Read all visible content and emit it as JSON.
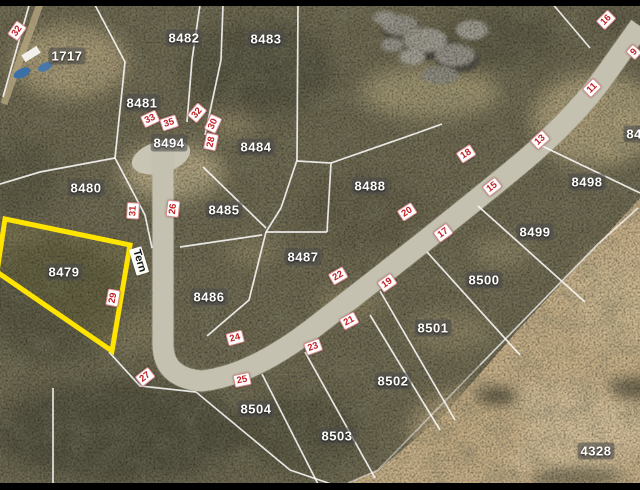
{
  "map": {
    "title": "Cadastral aerial map with highlighted lot",
    "street": {
      "name": "Tern",
      "x": 139,
      "y": 261,
      "rot": 73
    },
    "highlighted_parcel": {
      "id": "8479",
      "outline_color": "#ffe400"
    },
    "colors": {
      "street_number_text": "#c02125",
      "parcel_label_text": "#ffffff",
      "boundary_line": "#ffffff"
    },
    "parcels": [
      {
        "id": "1717",
        "x": 67,
        "y": 56
      },
      {
        "id": "8482",
        "x": 184,
        "y": 38
      },
      {
        "id": "8483",
        "x": 266,
        "y": 39
      },
      {
        "id": "8481",
        "x": 142,
        "y": 103
      },
      {
        "id": "8494",
        "x": 169,
        "y": 143
      },
      {
        "id": "8484",
        "x": 256,
        "y": 147
      },
      {
        "id": "8480",
        "x": 86,
        "y": 188
      },
      {
        "id": "8485",
        "x": 224,
        "y": 210
      },
      {
        "id": "8488",
        "x": 370,
        "y": 186
      },
      {
        "id": "8498",
        "x": 587,
        "y": 182
      },
      {
        "id": "8487",
        "x": 303,
        "y": 257
      },
      {
        "id": "8499",
        "x": 535,
        "y": 232
      },
      {
        "id": "8486",
        "x": 209,
        "y": 297
      },
      {
        "id": "8479",
        "x": 64,
        "y": 272
      },
      {
        "id": "8500",
        "x": 484,
        "y": 280
      },
      {
        "id": "8501",
        "x": 433,
        "y": 328
      },
      {
        "id": "8502",
        "x": 393,
        "y": 381
      },
      {
        "id": "8504",
        "x": 256,
        "y": 409
      },
      {
        "id": "8503",
        "x": 337,
        "y": 436
      },
      {
        "id": "4328",
        "x": 596,
        "y": 451
      },
      {
        "id": "849",
        "x": 638,
        "y": 134
      }
    ],
    "street_numbers": [
      {
        "n": "32",
        "x": 17,
        "y": 31,
        "rot": -55
      },
      {
        "n": "33",
        "x": 150,
        "y": 119,
        "rot": -25
      },
      {
        "n": "35",
        "x": 169,
        "y": 123,
        "rot": -18
      },
      {
        "n": "32",
        "x": 197,
        "y": 113,
        "rot": -50
      },
      {
        "n": "30",
        "x": 213,
        "y": 124,
        "rot": -65
      },
      {
        "n": "28",
        "x": 211,
        "y": 142,
        "rot": -78
      },
      {
        "n": "26",
        "x": 173,
        "y": 209,
        "rot": -83
      },
      {
        "n": "31",
        "x": 133,
        "y": 211,
        "rot": -87
      },
      {
        "n": "29",
        "x": 113,
        "y": 298,
        "rot": -80
      },
      {
        "n": "27",
        "x": 145,
        "y": 377,
        "rot": -38
      },
      {
        "n": "25",
        "x": 242,
        "y": 380,
        "rot": -12
      },
      {
        "n": "24",
        "x": 235,
        "y": 338,
        "rot": -15
      },
      {
        "n": "23",
        "x": 313,
        "y": 347,
        "rot": -20
      },
      {
        "n": "21",
        "x": 349,
        "y": 321,
        "rot": -28
      },
      {
        "n": "22",
        "x": 338,
        "y": 276,
        "rot": -30
      },
      {
        "n": "19",
        "x": 387,
        "y": 283,
        "rot": -35
      },
      {
        "n": "20",
        "x": 407,
        "y": 212,
        "rot": -33
      },
      {
        "n": "17",
        "x": 443,
        "y": 233,
        "rot": -36
      },
      {
        "n": "18",
        "x": 466,
        "y": 154,
        "rot": -33
      },
      {
        "n": "15",
        "x": 492,
        "y": 187,
        "rot": -38
      },
      {
        "n": "13",
        "x": 540,
        "y": 140,
        "rot": -42
      },
      {
        "n": "11",
        "x": 592,
        "y": 88,
        "rot": -45
      },
      {
        "n": "16",
        "x": 606,
        "y": 20,
        "rot": -45
      },
      {
        "n": "9",
        "x": 634,
        "y": 52,
        "rot": -48
      }
    ]
  }
}
